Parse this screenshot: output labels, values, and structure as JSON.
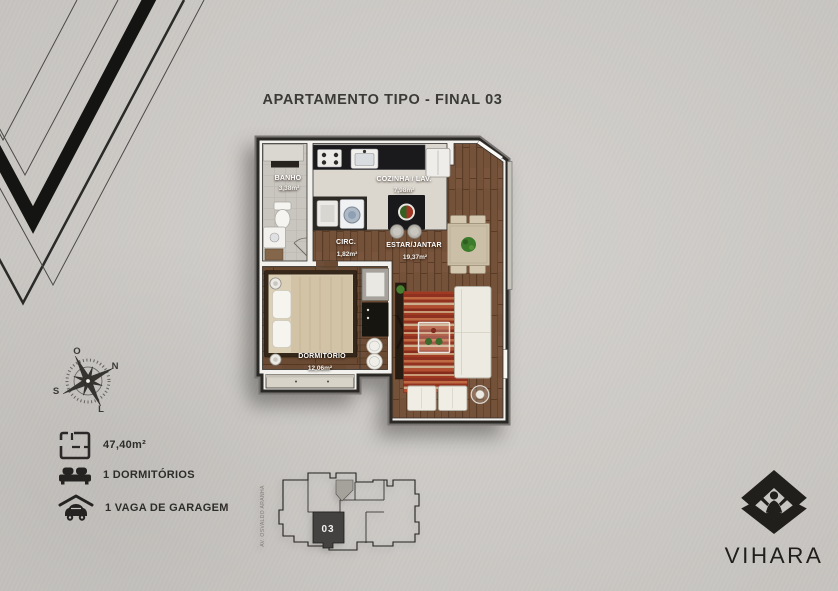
{
  "title": "APARTAMENTO TIPO - FINAL 03",
  "floor_plan": {
    "rooms": [
      {
        "name": "BANHO",
        "area": "3,38m²"
      },
      {
        "name": "COZINHA / LAV.",
        "area": "7,98m²"
      },
      {
        "name": "CIRC.",
        "area": "1,82m²"
      },
      {
        "name": "ESTAR/JANTAR",
        "area": "19,37m²"
      },
      {
        "name": "DORMITÓRIO",
        "area": "12,06m²"
      }
    ]
  },
  "compass": {
    "west": "O",
    "north": "N",
    "south": "S",
    "east": "L"
  },
  "stats": {
    "total_area": "47,40m²",
    "bedrooms": "1 DORMITÓRIOS",
    "parking": "1 VAGA DE GARAGEM"
  },
  "key_plan": {
    "unit_number": "03",
    "street": "AV. OSVALDO ARANHA"
  },
  "brand": {
    "name": "VIHARA"
  },
  "colors": {
    "background": "#c7c5c1",
    "ink": "#2e2d2a",
    "wood_floor": "#745139",
    "rug_red": "#9c3a24",
    "unit_highlight": "#434240"
  }
}
